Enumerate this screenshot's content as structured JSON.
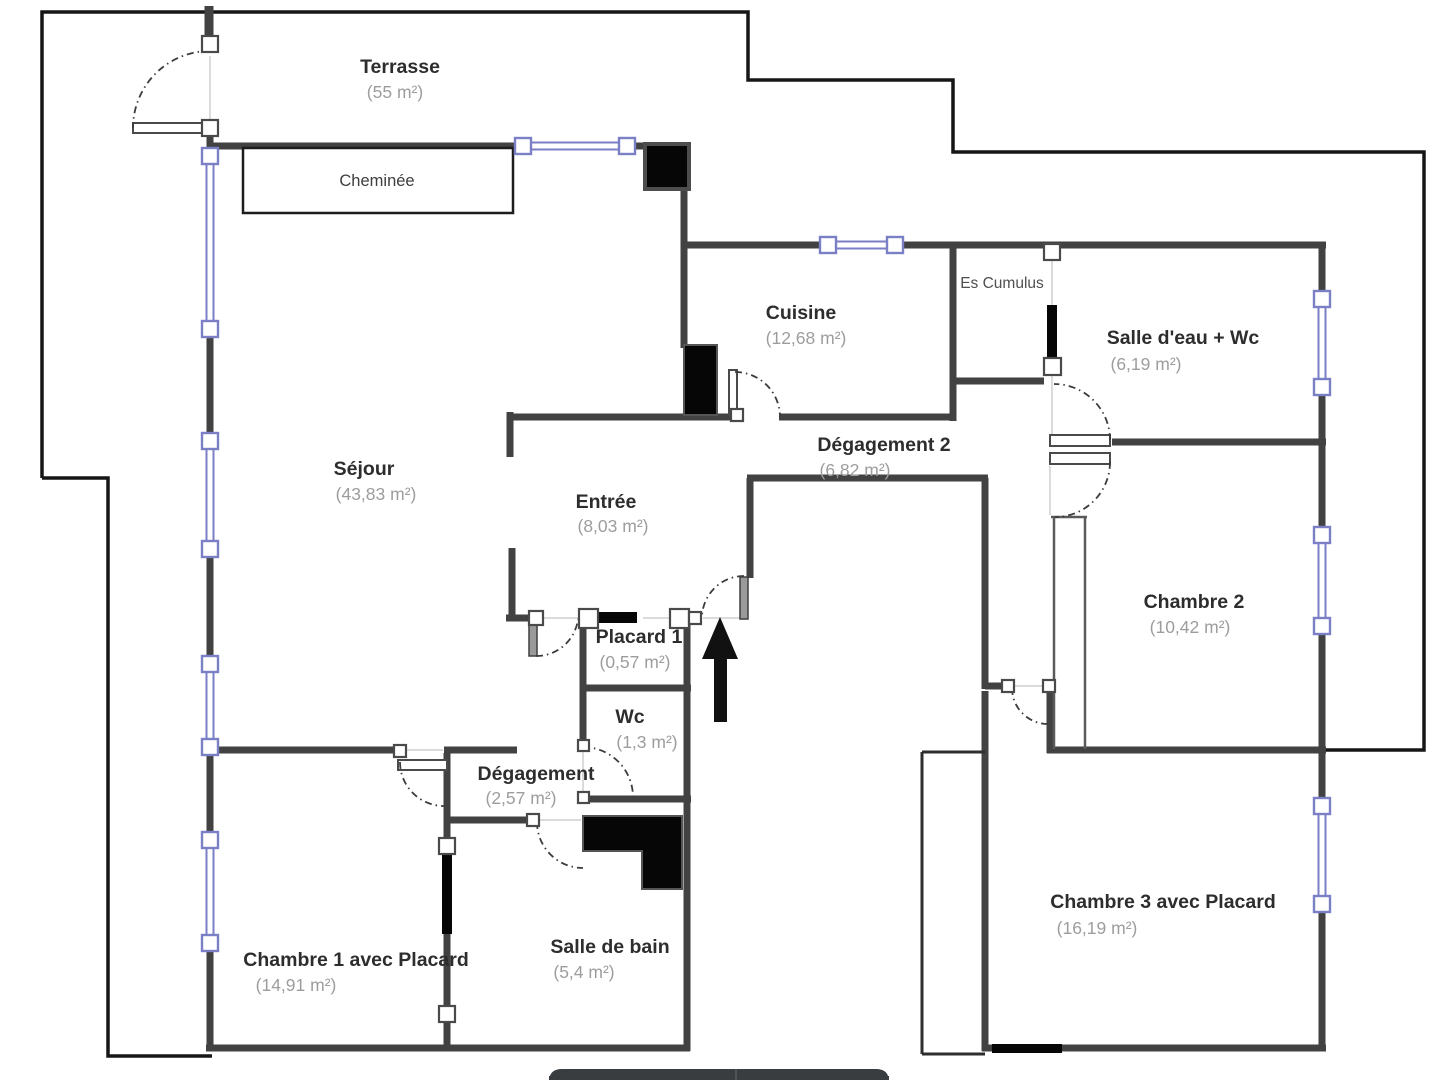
{
  "plan": {
    "rooms": [
      {
        "id": "terrasse",
        "name": "Terrasse",
        "area": "(55 m²)"
      },
      {
        "id": "cuisine",
        "name": "Cuisine",
        "area": "(12,68 m²)"
      },
      {
        "id": "salle-deau-wc",
        "name": "Salle d'eau + Wc",
        "area": "(6,19 m²)"
      },
      {
        "id": "sejour",
        "name": "Séjour",
        "area": "(43,83 m²)"
      },
      {
        "id": "degagement-2",
        "name": "Dégagement 2",
        "area": "(6,82 m²)"
      },
      {
        "id": "entree",
        "name": "Entrée",
        "area": "(8,03 m²)"
      },
      {
        "id": "chambre-2",
        "name": "Chambre 2",
        "area": "(10,42 m²)"
      },
      {
        "id": "placard-1",
        "name": "Placard 1",
        "area": "(0,57 m²)"
      },
      {
        "id": "wc",
        "name": "Wc",
        "area": "(1,3 m²)"
      },
      {
        "id": "degagement",
        "name": "Dégagement",
        "area": "(2,57 m²)"
      },
      {
        "id": "chambre-1",
        "name": "Chambre 1 avec Placard",
        "area": "(14,91 m²)"
      },
      {
        "id": "salle-de-bain",
        "name": "Salle de bain",
        "area": "(5,4 m²)"
      },
      {
        "id": "chambre-3",
        "name": "Chambre 3 avec Placard",
        "area": "(16,19 m²)"
      }
    ],
    "annotations": [
      {
        "id": "cheminee",
        "label": "Cheminée"
      },
      {
        "id": "es-cumulus",
        "label": "Es Cumulus"
      }
    ],
    "colors": {
      "wall": "#424242",
      "outer_boundary": "#161616",
      "window": "#7b7fc6",
      "door_fill": "#060606",
      "room_label": "#2d2d2d",
      "area_label": "#9d9d9d",
      "taskbar": "#3a3d40",
      "background": "#ffffff"
    }
  }
}
